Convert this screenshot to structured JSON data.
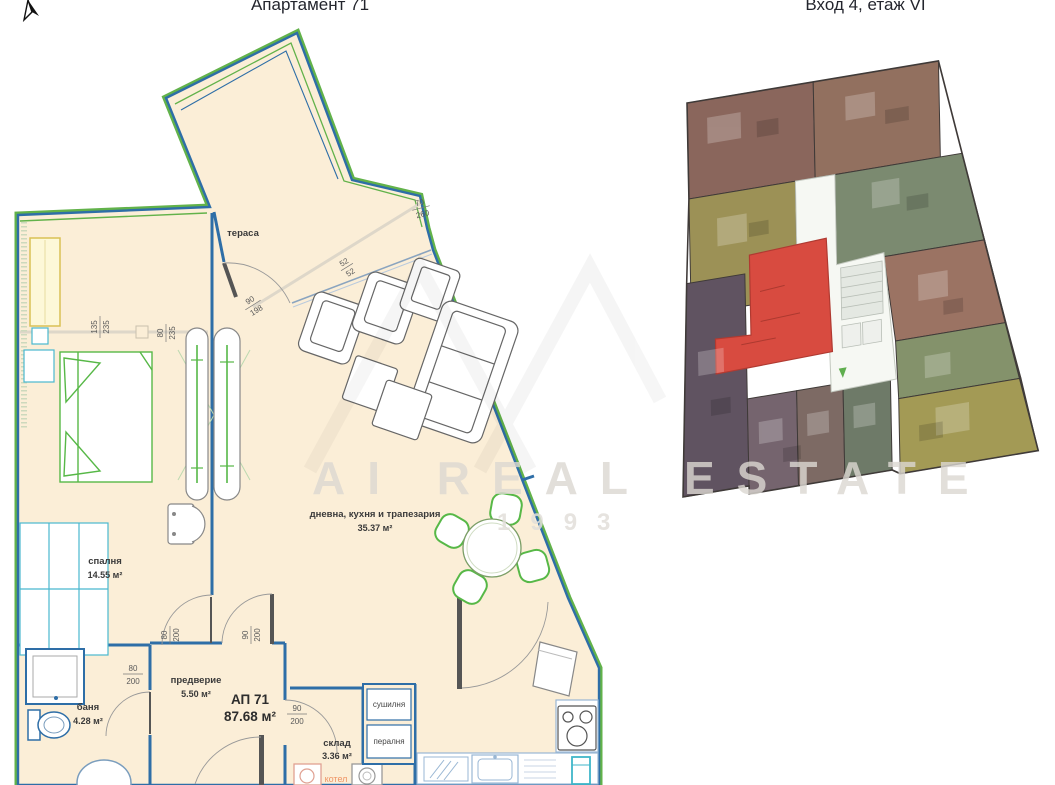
{
  "header": {
    "left_title": "Апартамент 71",
    "right_title": "Вход 4, етаж VI"
  },
  "floor_plan": {
    "fill_color": "#fbeed7",
    "wall_color": "#2e6ea7",
    "outline_green": "#62b24a",
    "rooms": {
      "terrace": {
        "name": "тераса"
      },
      "bedroom": {
        "name": "спалня",
        "area": "14.55 м²"
      },
      "living": {
        "name": "дневна, кухня и трапезария",
        "area": "35.37 м²"
      },
      "bath": {
        "name": "баня",
        "area": "4.28 м²"
      },
      "hall": {
        "name": "предверие",
        "area": "5.50 м²"
      },
      "storage": {
        "name": "склад",
        "area": "3.36 м²"
      },
      "dryer": {
        "name": "сушилня"
      },
      "laundry": {
        "name": "пералня"
      },
      "boiler": {
        "name": "котел"
      }
    },
    "apartment": {
      "code": "АП 71",
      "area": "87.68 м²"
    },
    "dims": [
      {
        "n": "135",
        "d": "235"
      },
      {
        "n": "80",
        "d": "235"
      },
      {
        "n": "70",
        "d": "260"
      },
      {
        "n": "52",
        "d": "52"
      },
      {
        "n": "90",
        "d": "198"
      },
      {
        "n": "80",
        "d": "200"
      },
      {
        "n": "80",
        "d": "200"
      },
      {
        "n": "90",
        "d": "200"
      },
      {
        "n": "90",
        "d": "200"
      }
    ]
  },
  "site_plan": {
    "corridor_color": "#f6f8f3",
    "highlight": {
      "color": "#d84b40"
    },
    "units": [
      {
        "id": "top-left-brown",
        "color": "#8a665c"
      },
      {
        "id": "top-right-brown",
        "color": "#92705f"
      },
      {
        "id": "left-olive",
        "color": "#9c9156"
      },
      {
        "id": "left-dark-purple",
        "color": "#605361"
      },
      {
        "id": "wing-gray-green",
        "color": "#7b8a70"
      },
      {
        "id": "wing-salmon",
        "color": "#9b7363"
      },
      {
        "id": "wing-green",
        "color": "#84926b"
      },
      {
        "id": "wing-olive-yellow",
        "color": "#a39a55"
      },
      {
        "id": "bottom-purple-gray",
        "color": "#75646e"
      },
      {
        "id": "bottom-brown-gray",
        "color": "#7d6a64"
      },
      {
        "id": "bottom-green-gray",
        "color": "#6e7a68"
      }
    ]
  },
  "watermark": {
    "line1": "AI REAL ESTATE",
    "line2": "1993"
  }
}
